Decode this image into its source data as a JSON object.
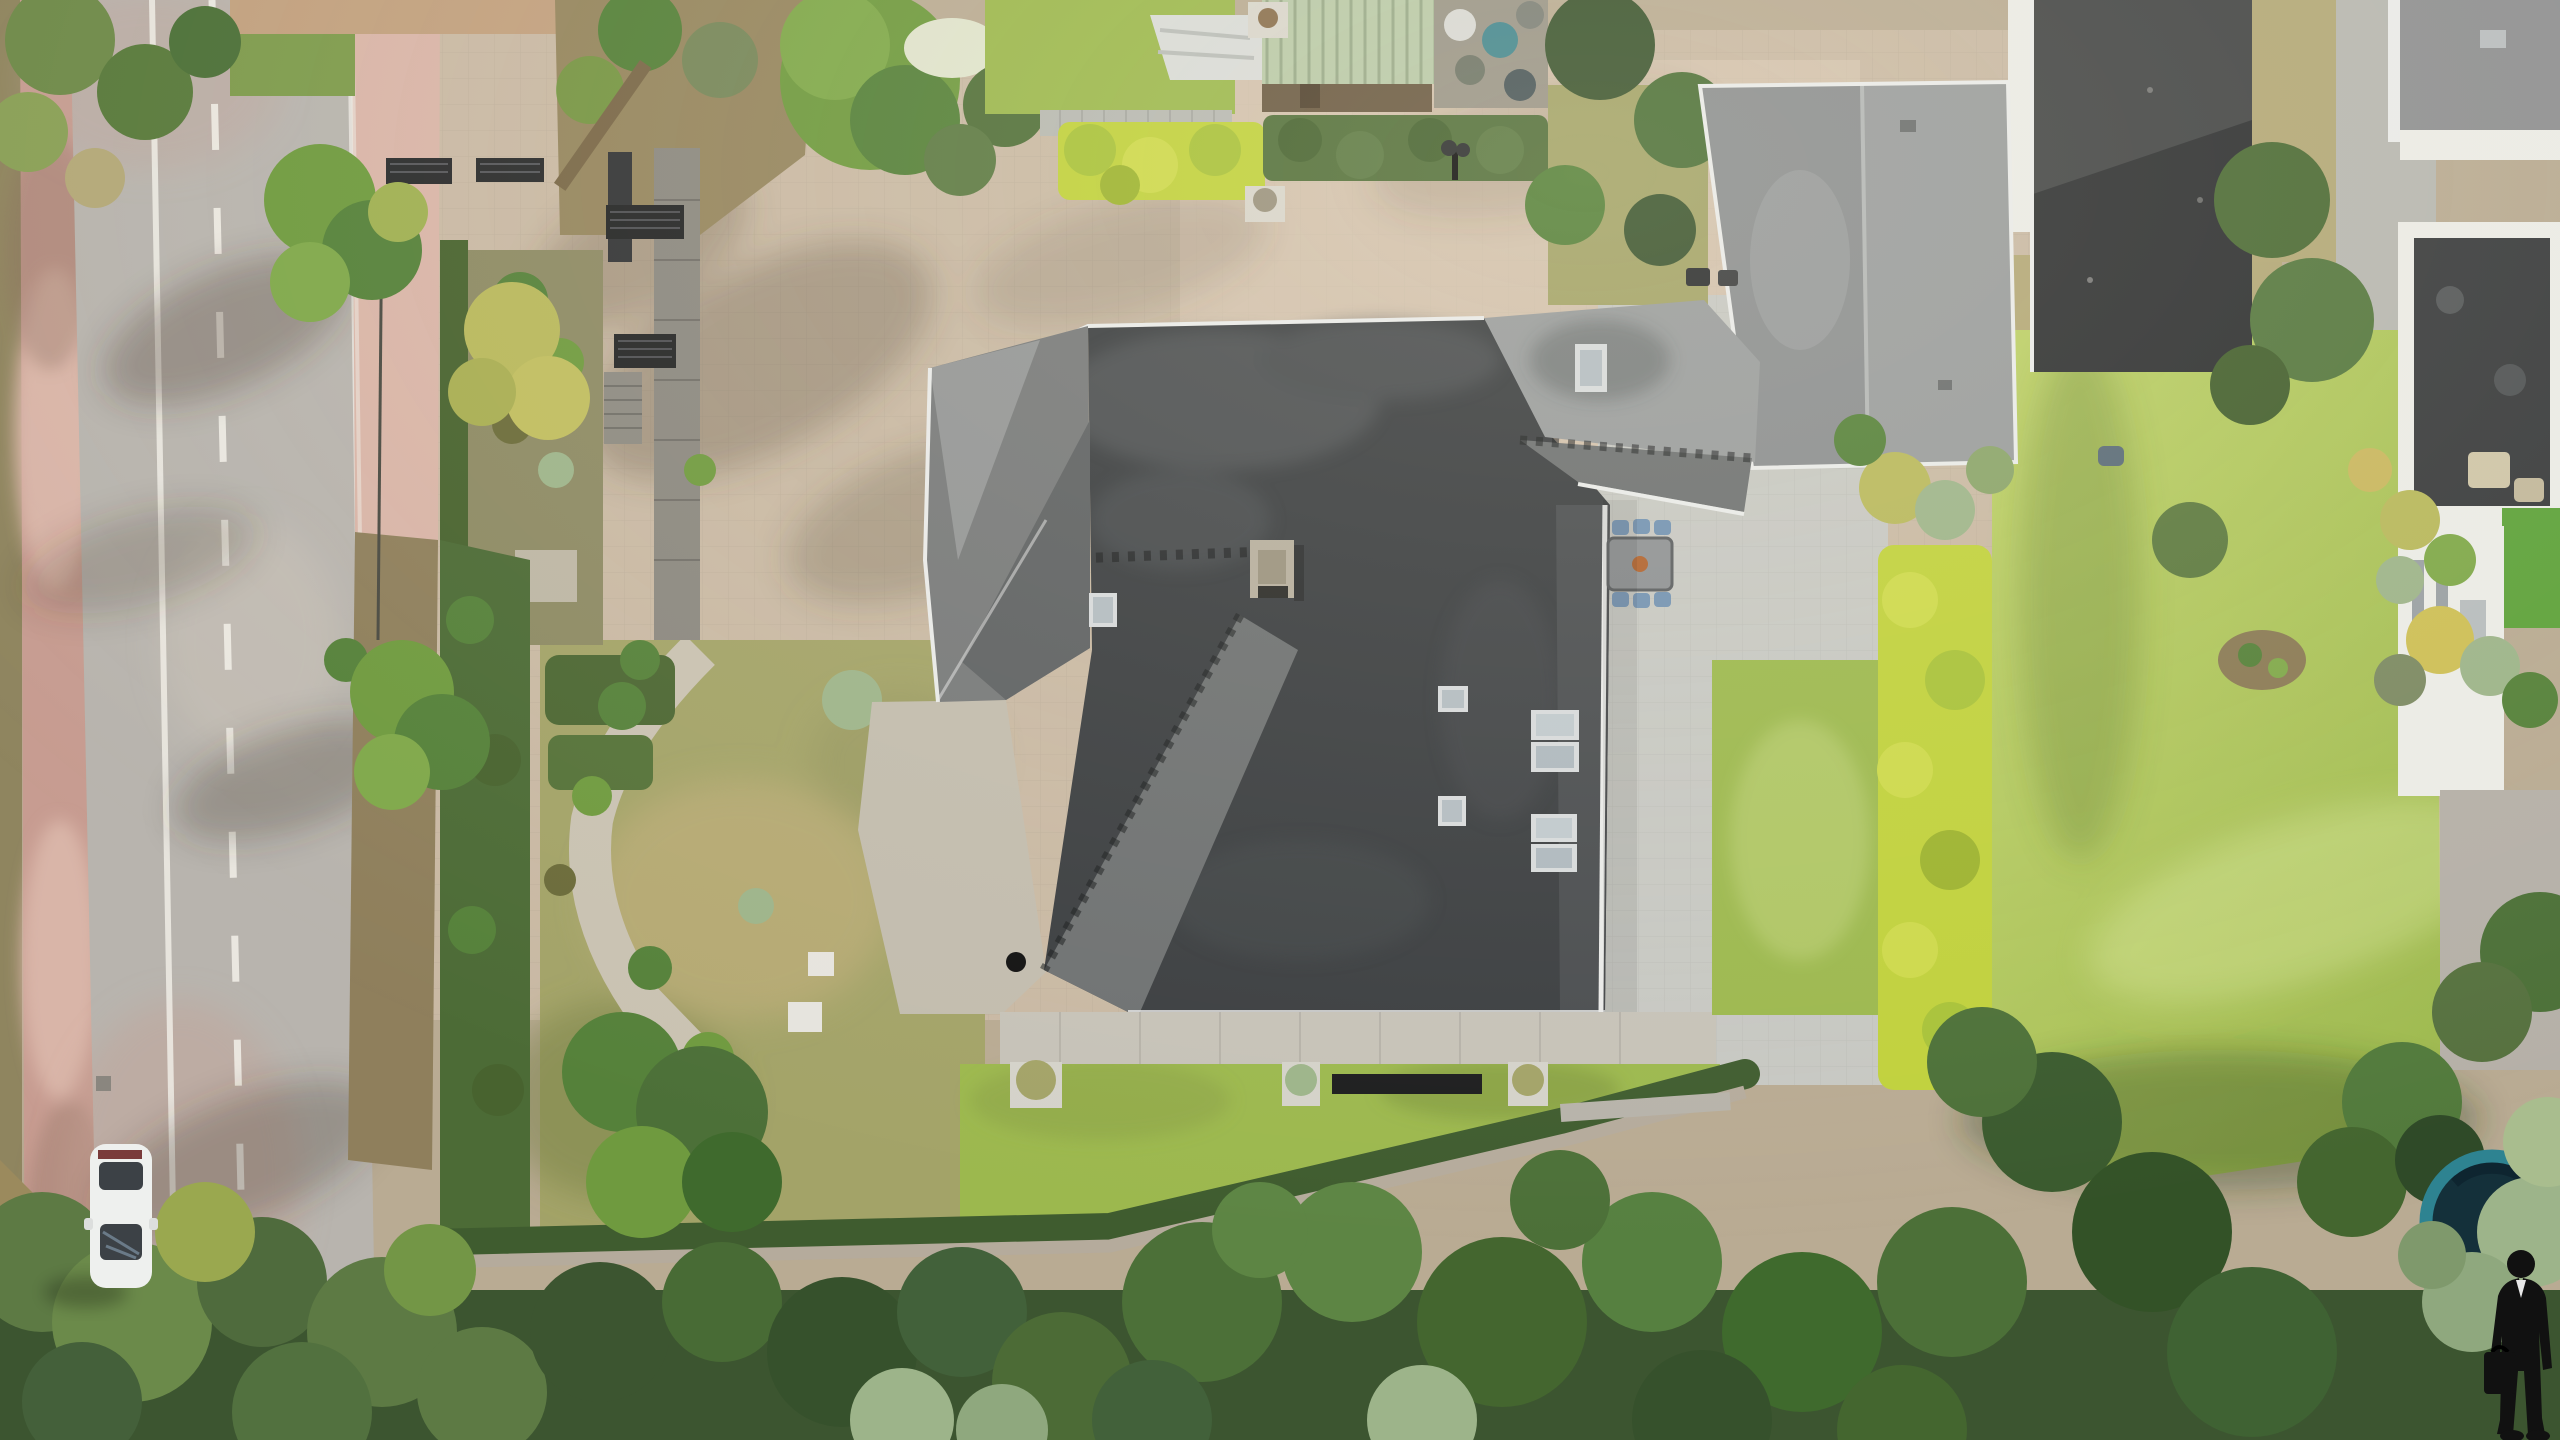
{
  "meta": {
    "kind": "aerial-drone-photograph",
    "orientation": "top-down",
    "canvas": {
      "width": 2560,
      "height": 1440
    },
    "subject": "villa with dark multi-hip slate roof, block-paved driveway, formal gardens, street on the left, forest at the bottom"
  },
  "palette": {
    "dirt": "#8f855f",
    "redpath": "#c79c91",
    "redpath_light": "#d9b5a8",
    "asphalt": "#b8b4ae",
    "roadline": "#f0ede6",
    "curb": "#d8d4ce",
    "paver": "#c9b9a4",
    "paver_light": "#dacbb6",
    "walk_dark": "#8b8880",
    "patio": "#c7c8c3",
    "terrace": "#c6c2b8",
    "stone": "#d8d5cc",
    "roof_dark": "#3b3e41",
    "roof_mid": "#6e7172",
    "roof_light": "#999c9d",
    "roof_pale": "#aeb0af",
    "gutter": "#e9eae9",
    "chimney": "#b6ae9e",
    "lawn": "#a9bf58",
    "lawn_bright": "#9cb84e",
    "lawn_olive": "#a3a368",
    "lawn_dry": "#b9ab76",
    "grass_dry": "#b3a878",
    "hedge_vivid": "#c0d13c",
    "hedge": "#48632f",
    "green1": "#6f9a3f",
    "green2": "#55813a",
    "green3": "#7fa84a",
    "pine": "#3c5530",
    "forest": "#4c7038",
    "sage": "#9db48a",
    "yellow_bush": "#b8b85c",
    "teal": "#2e8391",
    "teal_dark": "#14303a",
    "neighbor_roof": "#2f3133",
    "concrete": "#b7b7b1",
    "white_wall": "#ebebe6",
    "turf": "#5ea23b",
    "car_body": "#eef0ee",
    "glass": "#3c4146",
    "chair": "#7292b2",
    "table": "#8e9194",
    "black": "#111111"
  },
  "scene": {
    "road": {
      "markings": [
        "solid white edge line",
        "dashed white center line",
        "solid white right edge line"
      ],
      "bike_path_side": "left",
      "vehicles": [
        {
          "name": "white-car",
          "position": "lower left lane, heading down"
        }
      ]
    },
    "property": {
      "house": {
        "roof": "dark slate multi-hip with valleys",
        "wings": [
          "left-annex",
          "main-roof",
          "lower-left-wing",
          "right-wing",
          "top-wing"
        ],
        "skylights": 8,
        "chimneys": 1,
        "ridge_caps": "serrated tile caps on ridges"
      },
      "driveway": "large beige block paving with tree shadows",
      "entrance": [
        "dark slatted gates",
        "pergola beams",
        "dark paver walkway",
        "steps"
      ],
      "patio_dining": {
        "table": 1,
        "chairs": 6,
        "centerpiece": "orange planter"
      },
      "terrace": {
        "planters": 3,
        "cellar_grate": 1,
        "ball_lamp": 1
      },
      "hedges": [
        "vivid chartreuse L-shaped hedge",
        "dark boundary hedges"
      ],
      "garden_features": [
        "clipped shrub rows",
        "gravel path",
        "statue pedestal",
        "garden lamp",
        "white planter cubes",
        "boundary wall with bench"
      ]
    },
    "neighbors": [
      "pale-green corrugated shed with white tarp",
      "materials pile",
      "charcoal flat roofs",
      "white house with dark roof terrace",
      "astroturf patch",
      "concrete walk"
    ],
    "vegetation": [
      "street trees",
      "yellow-green bushes",
      "big round tree",
      "white flower cluster",
      "sage clumps",
      "dense pine forest band at bottom",
      "large sunlit lawn on right"
    ],
    "objects": [
      "teal-rimmed trampoline",
      "robot lawn mower",
      "two bbq grills",
      "wall bench"
    ],
    "watermark": {
      "description": "black silhouette of a person in a suit holding a briefcase",
      "position": "bottom-right corner"
    }
  }
}
